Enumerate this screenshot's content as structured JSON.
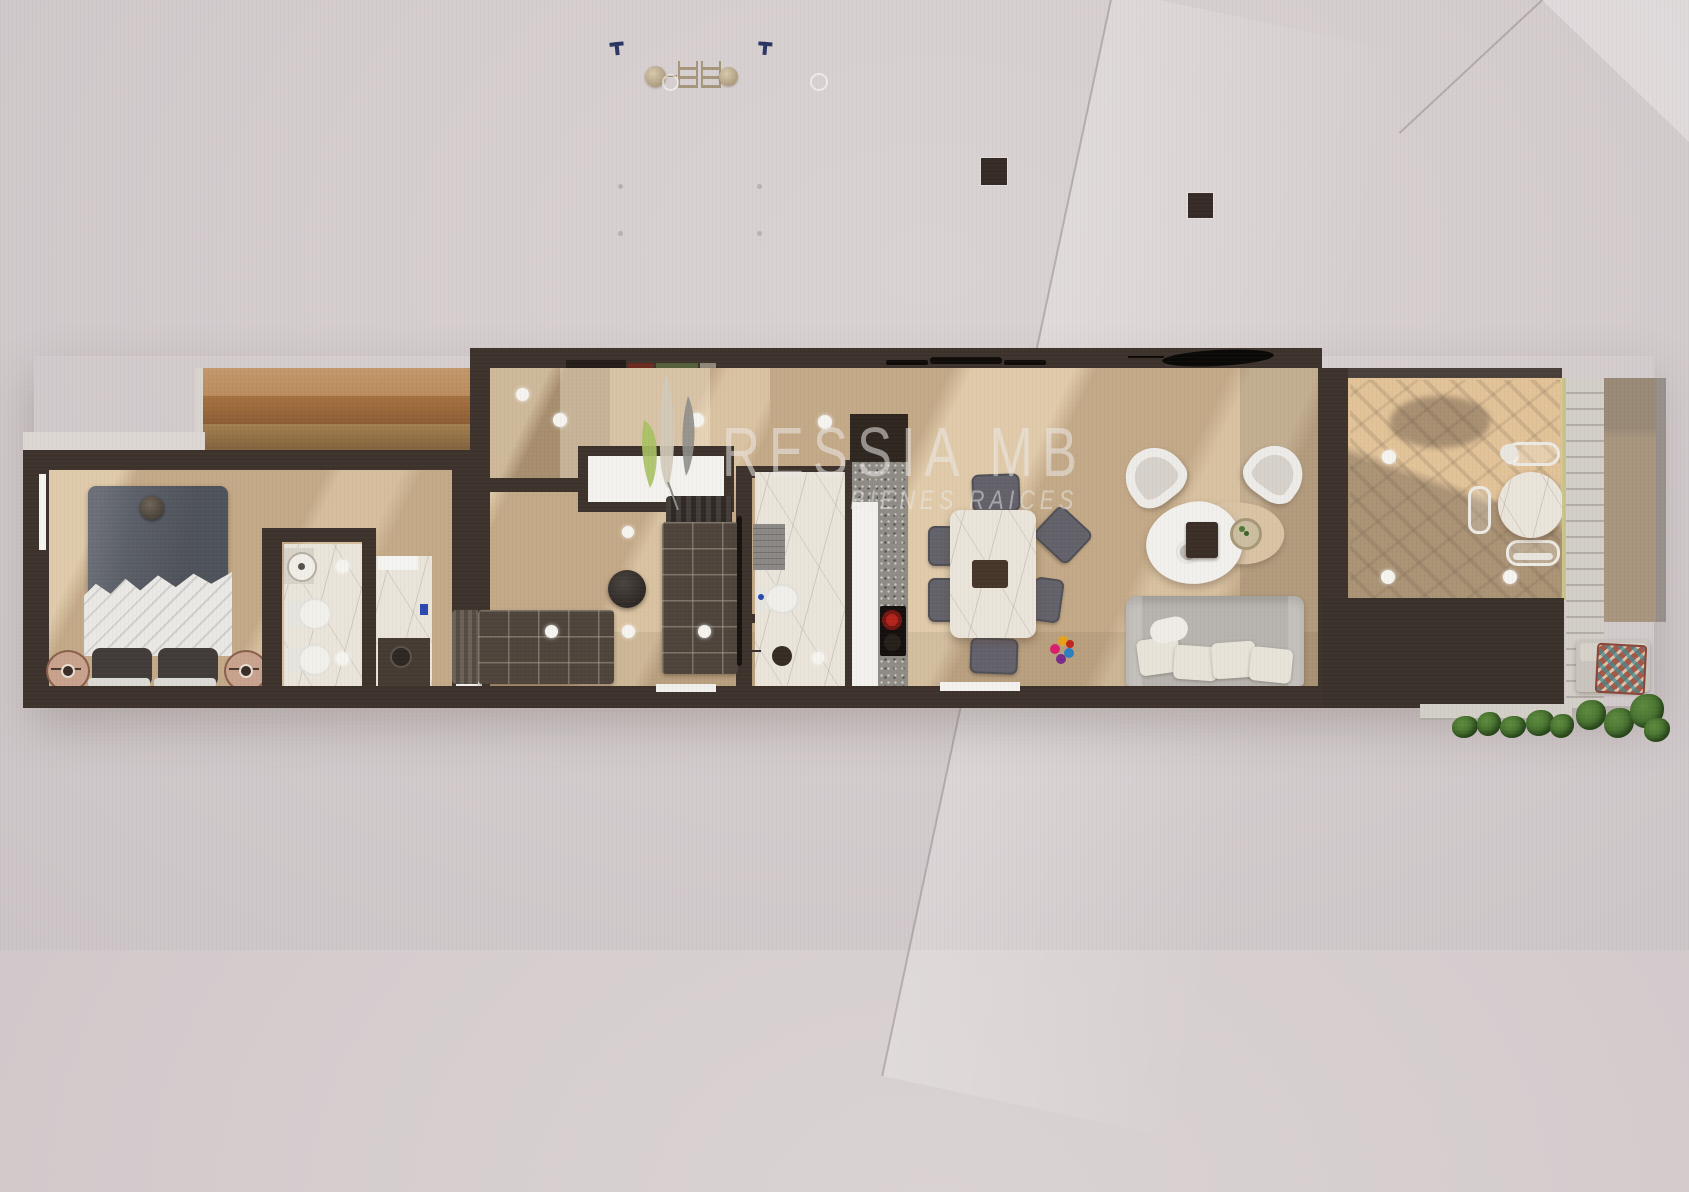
{
  "scene": {
    "description": "Top-down 3D render of a long, narrow apartment floor plan on a light pink-gray backdrop, watermarked by a real-estate brand"
  },
  "watermark": {
    "brand": "RESSIA MB",
    "tagline": "BIENES RAICES",
    "logo": "three-plume-leaf-logo"
  },
  "plan": {
    "sections": [
      {
        "name": "wood-deck"
      },
      {
        "name": "master-bedroom",
        "furniture": [
          "double-bed",
          "nightstand-left",
          "nightstand-right"
        ]
      },
      {
        "name": "master-bathroom",
        "fixtures": [
          "round-sink",
          "toilet",
          "bidet",
          "shower"
        ]
      },
      {
        "name": "bedroom-2",
        "furniture": [
          "single-bed",
          "pouf",
          "white-closet"
        ]
      },
      {
        "name": "bedroom-3",
        "furniture": [
          "single-bed-vertical",
          "striped-headboard"
        ]
      },
      {
        "name": "bathroom-2",
        "fixtures": [
          "toilet",
          "shower",
          "bath-mat"
        ]
      },
      {
        "name": "kitchen",
        "features": [
          "white-island",
          "granite-counter",
          "cooktop",
          "red-pot"
        ]
      },
      {
        "name": "dining",
        "furniture": [
          "marble-dining-table",
          "six-gray-chairs",
          "dark-centerpiece"
        ]
      },
      {
        "name": "living",
        "furniture": [
          "gray-sofa",
          "two-cream-armchairs",
          "organic-coffee-table",
          "plant-bowl",
          "colorful-toy"
        ]
      },
      {
        "name": "terrace",
        "furniture": [
          "round-marble-table",
          "three-curved-chairs"
        ],
        "features": [
          "tree-shadow",
          "stair-shadow",
          "ceiling-lights"
        ]
      },
      {
        "name": "stone-walkway"
      },
      {
        "name": "garden-corner",
        "furniture": [
          "bench",
          "patterned-pillow"
        ],
        "features": [
          "shrub-row"
        ]
      }
    ],
    "markers": {
      "ceiling_lights": "white recessed-light dots across rooms",
      "roof_elements": "black slats and lens-shaped louvers above top wall",
      "columns": "two dark brown squares on backdrop",
      "misc_symbols": "two navy T marks, brass knobs and ladder sconces, faint rings"
    }
  },
  "colors": {
    "wall": "#3d332c",
    "wallDark": "#2c241f",
    "floor": "#c3a987",
    "floorSun": "#f0d6aa",
    "terrace": "#e2c398",
    "marble": "#eae4da",
    "granite": "#8f8b85",
    "counterWhite": "#f2f1ed",
    "duvet": "#5b5f68",
    "sheet": "#e9e8e4",
    "quilt": "#4e443b",
    "chair": "#63616a",
    "sofa": "#b7b3ae",
    "cushion": "#e7e3d9",
    "armchair": "#edebe7",
    "tray": "#3a2e26",
    "redPot": "#b3241b",
    "blueMark": "#2a49b0",
    "navyMark": "#2b3663",
    "brass": "#bfae92",
    "squares": "#362b26",
    "plant": "#46712f",
    "pillowRust": "#a65847",
    "pillowTeal": "#3f8e95",
    "leafGreen": "#a9c162",
    "leafBeige": "#d3cab8",
    "leafGray": "#8f8e8a",
    "watermark": "rgba(236,234,231,0.55)"
  }
}
